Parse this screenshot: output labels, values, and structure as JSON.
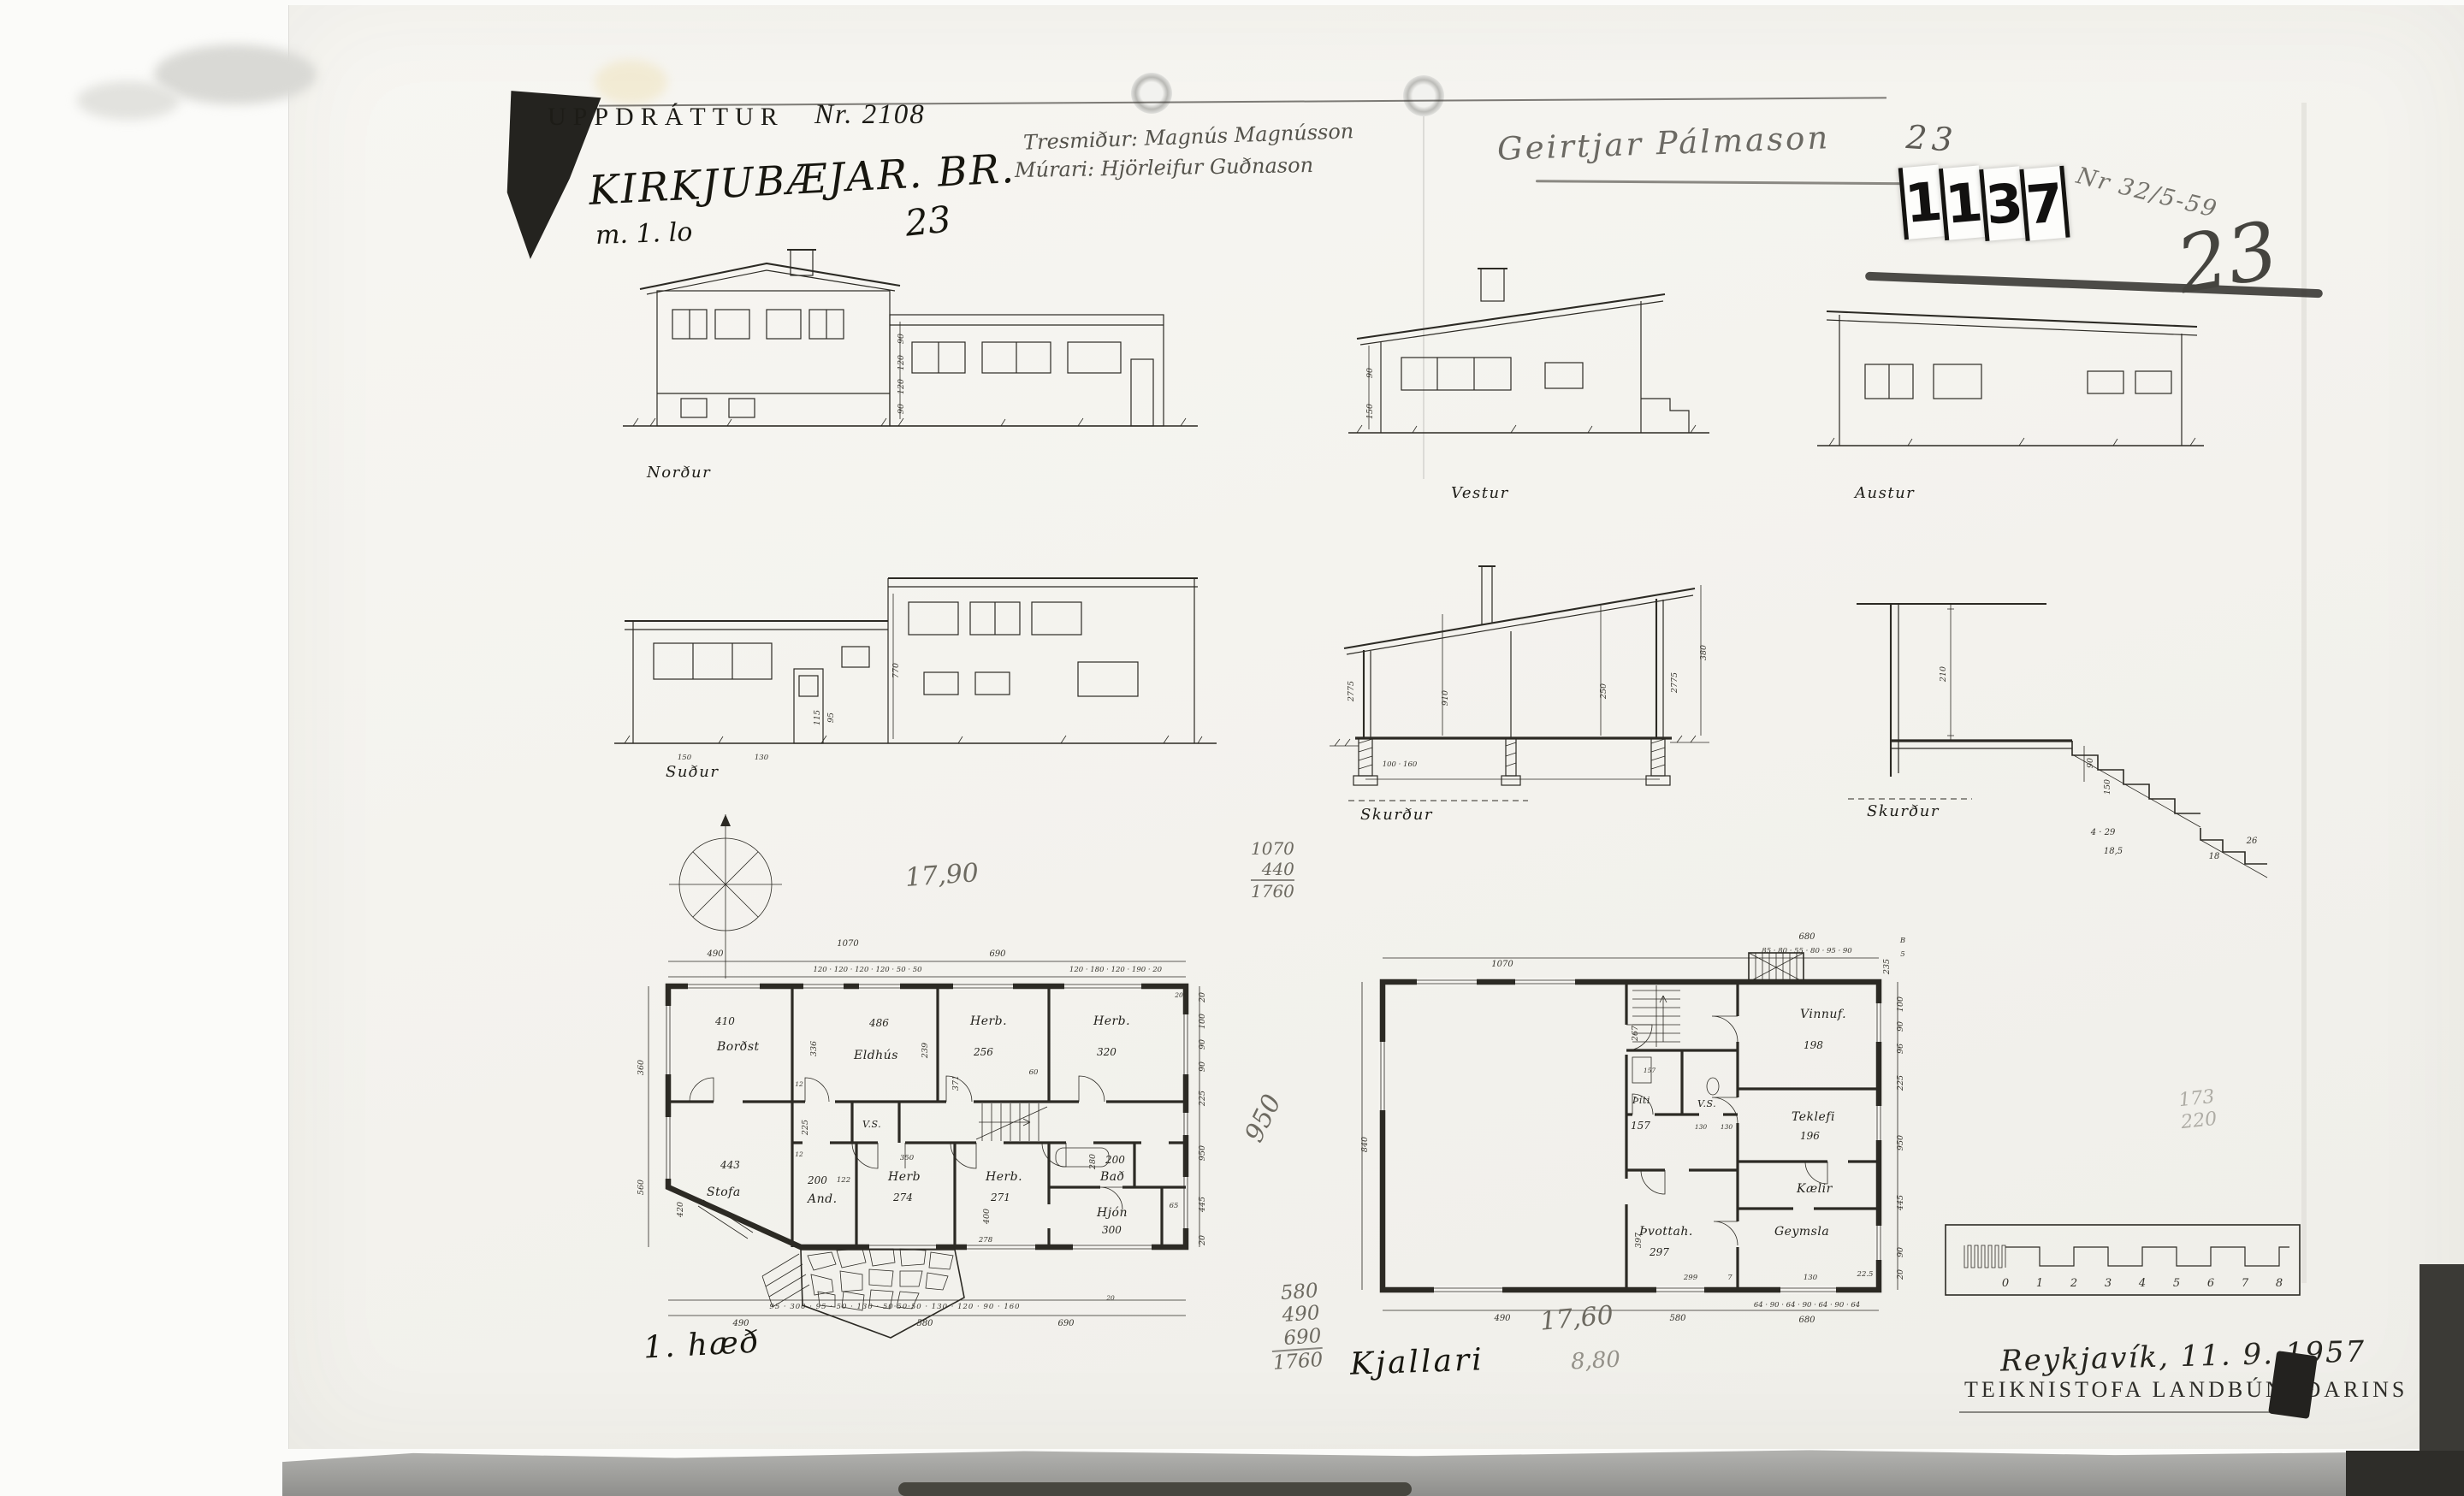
{
  "header": {
    "typed_title": "UPPDRÁTTUR",
    "typed_number": "Nr. 2108",
    "hand_title": "KIRKJUBÆJAR. BR.",
    "hand_subtitle": "m. 1. lo",
    "hand_number": "23",
    "pencil_credit_1": "Tresmiður: Magnús Magnússon",
    "pencil_credit_2": "Múrari: Hjörleifur Guðnason",
    "pencil_name": "Geirtjar Pálmason",
    "pencil_number_small": "23",
    "stamp_digits": [
      "1",
      "1",
      "3",
      "7"
    ],
    "pencil_filing_note": "Nr 32/5-59",
    "pencil_number_big": "23"
  },
  "elevations": {
    "north": {
      "label": "Norður",
      "dims": [
        "90",
        "120",
        "120",
        "90"
      ]
    },
    "west": {
      "label": "Vestur",
      "dims": [
        "90",
        "150"
      ]
    },
    "east": {
      "label": "Austur"
    },
    "south": {
      "label": "Suður",
      "dims": [
        "770",
        "115",
        "95",
        "150",
        "130"
      ]
    },
    "section_a": {
      "label": "Skurður",
      "dims": [
        "2775",
        "910",
        "250",
        "2775",
        "380",
        "100 · 160"
      ]
    },
    "section_b": {
      "label": "Skurður",
      "dims": [
        "210",
        "90",
        "150",
        "4 · 29",
        "18,5",
        "18",
        "26"
      ]
    }
  },
  "floor1": {
    "label": "1. hæð",
    "pencil": {
      "total": "17,90",
      "stack": [
        "1070",
        "440",
        "1760"
      ],
      "diag": "950"
    },
    "rooms": {
      "bordst": {
        "name": "Borðst",
        "area": "410"
      },
      "eldhus": {
        "name": "Eldhús",
        "area": "486"
      },
      "herb1": {
        "name": "Herb.",
        "area": "256"
      },
      "herb2": {
        "name": "Herb.",
        "area": "320"
      },
      "bad": {
        "name": "Bað",
        "area": "200"
      },
      "stofa": {
        "name": "Stofa",
        "area": "443"
      },
      "and": {
        "name": "And.",
        "area": "200"
      },
      "herb3": {
        "name": "Herb",
        "area": "274"
      },
      "herb4": {
        "name": "Herb.",
        "area": "271"
      },
      "hjon": {
        "name": "Hjón",
        "area": "300"
      },
      "vs": {
        "name": "V.S."
      }
    },
    "dims": {
      "t1": "490",
      "t2": "1070",
      "t3": "120 · 120 · 120 · 120 · 50 · 50",
      "t4": "690",
      "t5": "120 · 180 · 120 · 190 · 20",
      "l1": "360",
      "l2": "560",
      "r1": "20",
      "r2": "100",
      "r3": "90",
      "r4": "90",
      "r5": "225",
      "r6": "950",
      "r7": "445",
      "r8": "20",
      "b1": "95 · 300 · 95 · 50 · 130 · 50·50·50 · 130 · 120 · 90 · 160",
      "b2": "20",
      "b3": "490",
      "b4": "580",
      "b5": "690",
      "i1": "336",
      "i2": "225",
      "i3": "239",
      "i4": "371",
      "i5": "60",
      "i6": "350",
      "i7": "280",
      "i8": "122",
      "i9": "400",
      "i10": "65",
      "i11": "278",
      "i12": "420",
      "i13": "12",
      "i14": "12",
      "i15": "20"
    }
  },
  "basement": {
    "label": "Kjallari",
    "pencil": {
      "sum": [
        "580",
        "490",
        "690",
        "1760"
      ],
      "total": "17,60",
      "total2": "8,80",
      "faint1": "173",
      "faint2": "220"
    },
    "rooms": {
      "vinnuf": {
        "name": "Vinnuf.",
        "area": "198"
      },
      "vs": {
        "name": "V.S."
      },
      "thiti": {
        "name": "Þiti",
        "area": "157"
      },
      "teklefi": {
        "name": "Teklefi",
        "area": "196"
      },
      "kaelir": {
        "name": "Kælir"
      },
      "thvottah": {
        "name": "Þvottah.",
        "area": "297"
      },
      "geymsla": {
        "name": "Geymsla"
      }
    },
    "dims": {
      "t1": "1070",
      "t2": "680",
      "t3": "85 · 80 · 55 · 80 · 95 · 90",
      "t4": "235",
      "c1": "B",
      "c2": "5",
      "l1": "840",
      "r1": "100",
      "r2": "90",
      "r3": "96",
      "r4": "225",
      "r5": "950",
      "r6": "445",
      "r7": "90",
      "r8": "20",
      "b1": "490",
      "b2": "580",
      "b3": "64 · 90 · 64 · 90 · 64 · 90 · 64",
      "b4": "680",
      "i1": "157",
      "i2": "130",
      "i3": "130",
      "i4": "267",
      "i5": "397",
      "i6": "299",
      "i7": "7",
      "i8": "130",
      "i9": "22.5"
    }
  },
  "footer": {
    "place_date": "Reykjavík, 11. 9. 1957",
    "office": "TEIKNISTOFA LANDBÚNAÐARINS",
    "scale_ticks": [
      "0",
      "1",
      "2",
      "3",
      "4",
      "5",
      "6",
      "7",
      "8"
    ]
  }
}
